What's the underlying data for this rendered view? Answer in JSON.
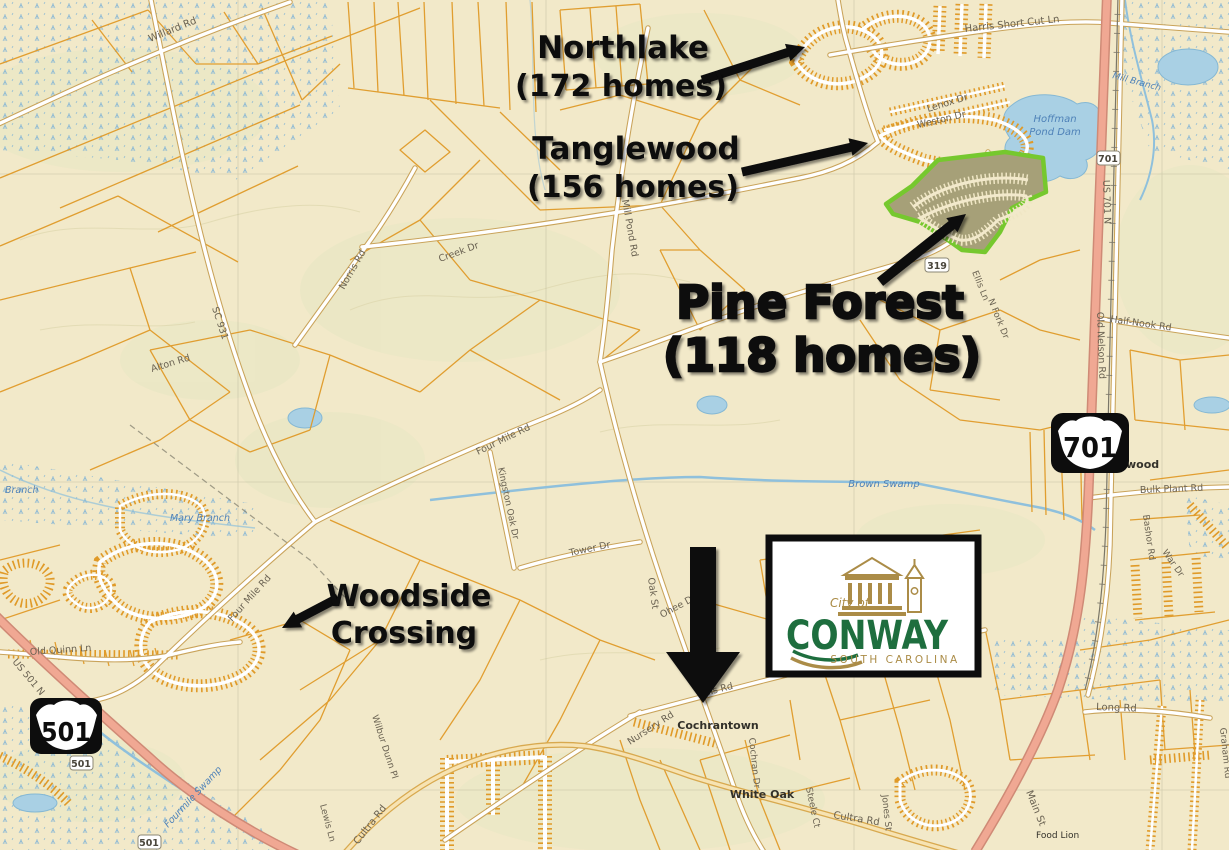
{
  "map": {
    "annotations": {
      "northlake": {
        "title": "Northlake",
        "subtitle": "(172 homes)"
      },
      "tanglewood": {
        "title": "Tanglewood",
        "subtitle": "(156 homes)"
      },
      "pine_forest": {
        "title": "Pine Forest",
        "subtitle": "(118 homes)"
      },
      "woodside": {
        "line1": "Woodside",
        "line2": "Crossing"
      }
    },
    "logo": {
      "city_of": "City of",
      "name": "CONWAY",
      "state": "SOUTH CAROLINA"
    },
    "shields": {
      "big_701": "701",
      "big_501": "501",
      "small_319": "319",
      "small_501_a": "501",
      "small_501_b": "501",
      "small_701": "701"
    },
    "road_labels": [
      "Willard Rd",
      "Harris Short Cut Ln",
      "Lenox Dr",
      "Weston Dr",
      "SC 931",
      "Alton Rd",
      "Norris Rd",
      "Creek Dr",
      "Mill Pond Rd",
      "Four Mile Rd",
      "Kingston Oak Dr",
      "Tower Dr",
      "Oak St",
      "Ohee Dr",
      "Four Mile Rd",
      "US 701 N",
      "Old Nelson Rd",
      "Half-Nook Rd",
      "Bulk Plant Rd",
      "Bashor Rd",
      "War Dr",
      "Long Rd",
      "Main St",
      "Ellis Rd",
      "Nursery Rd",
      "Cochran Dr",
      "Cultra Rd",
      "Jones St",
      "Cultra Rd",
      "Wilbur Dunn Pl",
      "Lewis Ln",
      "Old Quinn Ln",
      "US 501 N",
      "Graham Rd",
      "Steele Ct",
      "Ellis Ln",
      "N Fork Dr"
    ],
    "water_labels": [
      "Hoffman",
      "Pond Dam",
      "Mill Branch",
      "Brown Swamp",
      "Mary Branch",
      "Branch",
      "Fourmile Swamp"
    ],
    "place_labels": [
      "Cochrantown",
      "White Oak",
      "Food Lion",
      "wood"
    ]
  },
  "colors": {
    "background_beige": "#f2e9c9",
    "parcel_orange": "#e09a28",
    "highway_pink": "#f0a893",
    "water_blue": "#a9d0e4",
    "pine_forest_green": "#76c82e",
    "pine_forest_fill": "#a6a078",
    "logo_green": "#1e6e3e",
    "logo_gold": "#ab8c47"
  }
}
